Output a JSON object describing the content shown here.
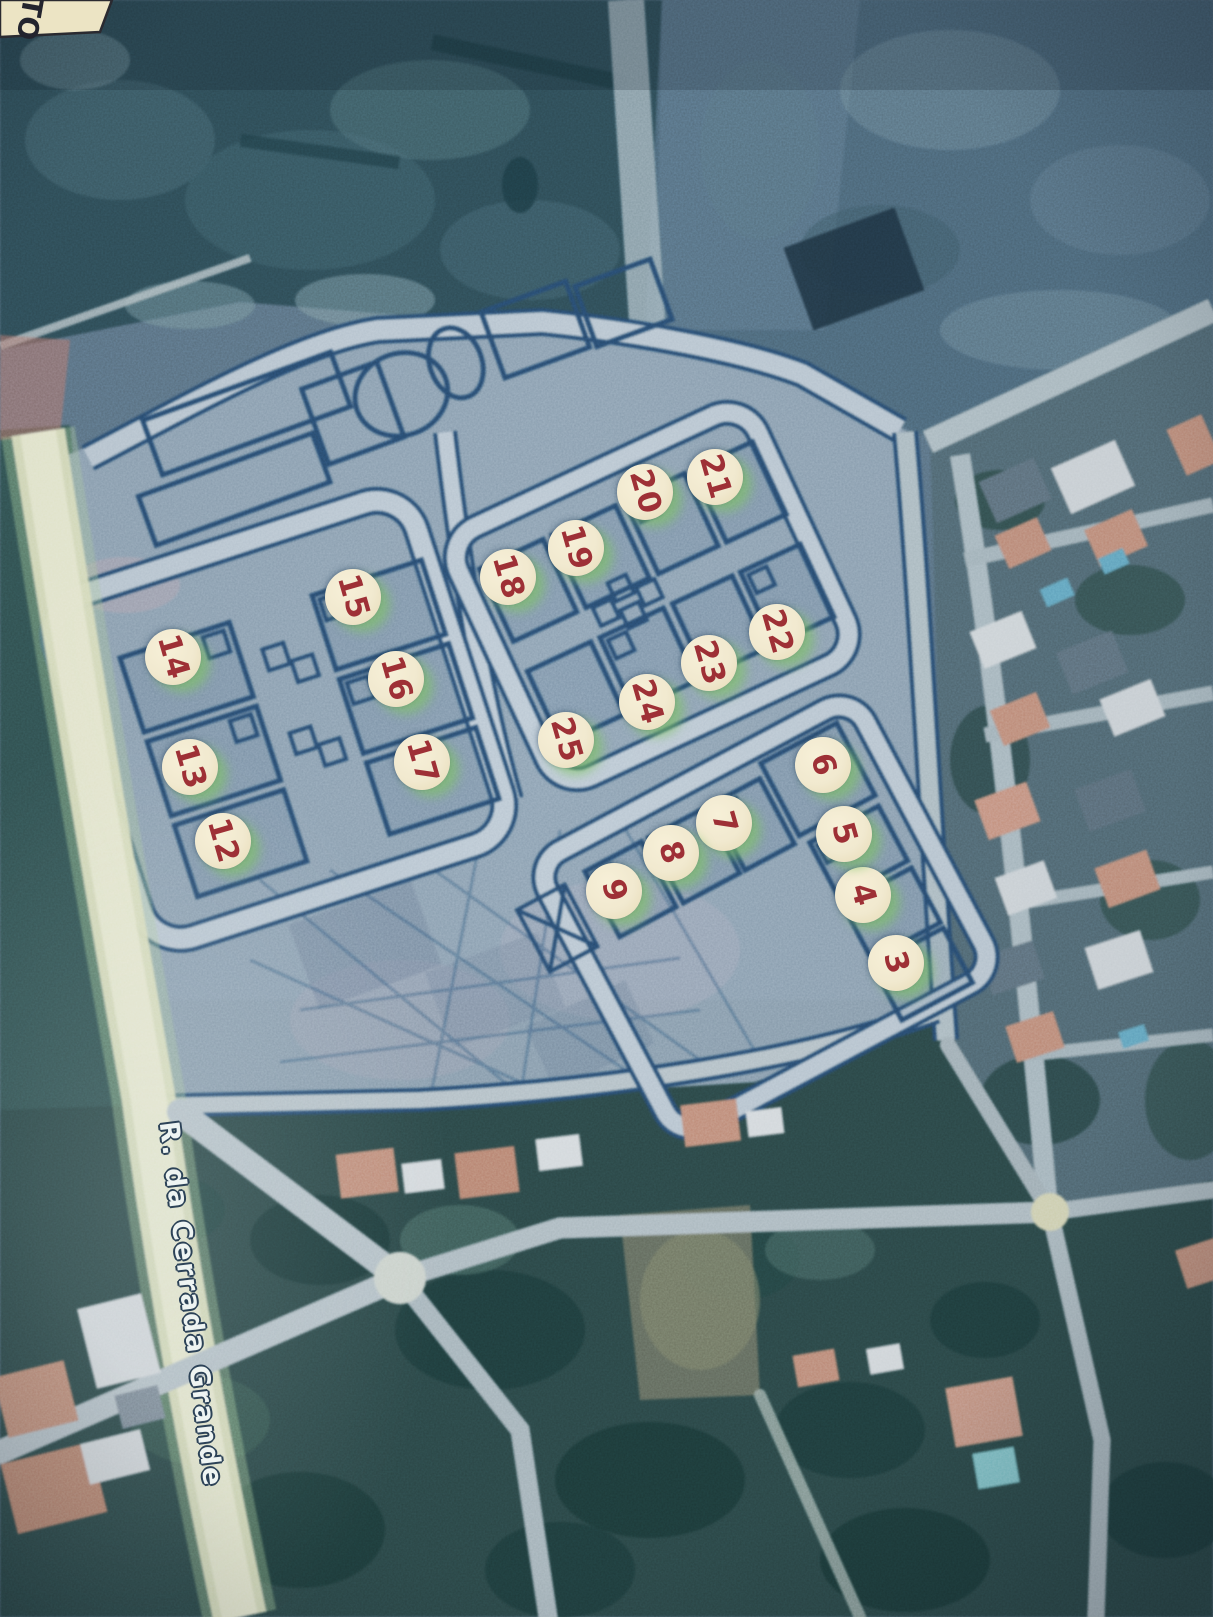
{
  "map": {
    "street_label": "R. da Cerrada Grande",
    "corner_note_text": "TO",
    "colors": {
      "marker_fill": "#f1e9cf",
      "marker_number": "#9e3036",
      "plan_line": "#27496b",
      "street_label_text": "#eef4f2",
      "road_yellow": "#e4e7c3"
    },
    "markers": [
      {
        "n": "3",
        "x": 896,
        "y": 963
      },
      {
        "n": "4",
        "x": 863,
        "y": 895
      },
      {
        "n": "5",
        "x": 844,
        "y": 834
      },
      {
        "n": "6",
        "x": 823,
        "y": 765
      },
      {
        "n": "7",
        "x": 724,
        "y": 823
      },
      {
        "n": "8",
        "x": 671,
        "y": 853
      },
      {
        "n": "9",
        "x": 614,
        "y": 891
      },
      {
        "n": "12",
        "x": 223,
        "y": 841
      },
      {
        "n": "13",
        "x": 190,
        "y": 767
      },
      {
        "n": "14",
        "x": 173,
        "y": 657
      },
      {
        "n": "15",
        "x": 353,
        "y": 597
      },
      {
        "n": "16",
        "x": 396,
        "y": 679
      },
      {
        "n": "17",
        "x": 422,
        "y": 762
      },
      {
        "n": "18",
        "x": 508,
        "y": 577
      },
      {
        "n": "19",
        "x": 576,
        "y": 548
      },
      {
        "n": "20",
        "x": 645,
        "y": 492
      },
      {
        "n": "21",
        "x": 715,
        "y": 477
      },
      {
        "n": "22",
        "x": 777,
        "y": 632
      },
      {
        "n": "23",
        "x": 709,
        "y": 663
      },
      {
        "n": "24",
        "x": 647,
        "y": 702
      },
      {
        "n": "25",
        "x": 566,
        "y": 740
      }
    ]
  }
}
